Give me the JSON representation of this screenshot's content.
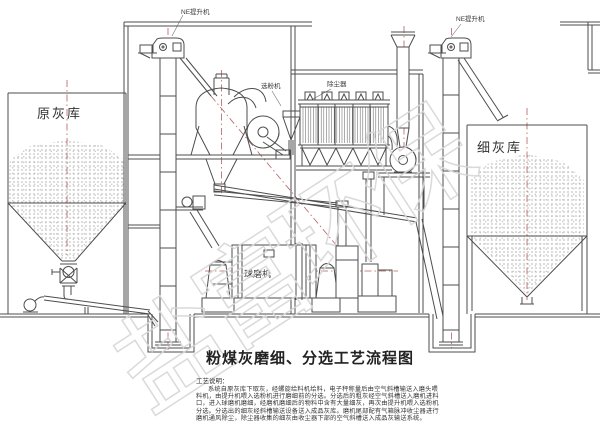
{
  "title": "粉煤灰磨细、分选工艺流程图",
  "labels": {
    "ne_elevator_left": "NE提升机",
    "ne_elevator_right": "NE提升机",
    "classifier": "选粉机",
    "dust_collector": "除尘器",
    "raw_ash_silo": "原灰库",
    "fine_ash_silo": "细灰库",
    "ball_mill": "球磨机"
  },
  "notes": {
    "heading": "工艺说明：",
    "lines": [
      "系统自原灰库下取灰，经螺旋给料机给料，电子秤称量后由空气斜槽输送入磨头喂",
      "料机，由提升机喂入选粉机进行磨细前的分选。分选后的粗灰经空气斜槽送入磨机进料",
      "口，进入球磨机磨细，经磨机磨细后的物料中含有大量细灰，再次由提升机喂入选粉机",
      "分选。分选出的细灰经斜槽输送设备送入成品灰库。磨机尾部配有气箱脉冲收尘器进行",
      "磨机通风除尘，除尘器收集的细灰由收尘器下部的空气斜槽送入成品灰输送系统。"
    ]
  },
  "watermark": {
    "chars": [
      "盐",
      "富",
      "环",
      "保"
    ]
  },
  "colors": {
    "line": "#4d4d4d",
    "centerline": "#b86060",
    "stipple": "#8a8a8a",
    "watermark": "#d6d6d6"
  }
}
